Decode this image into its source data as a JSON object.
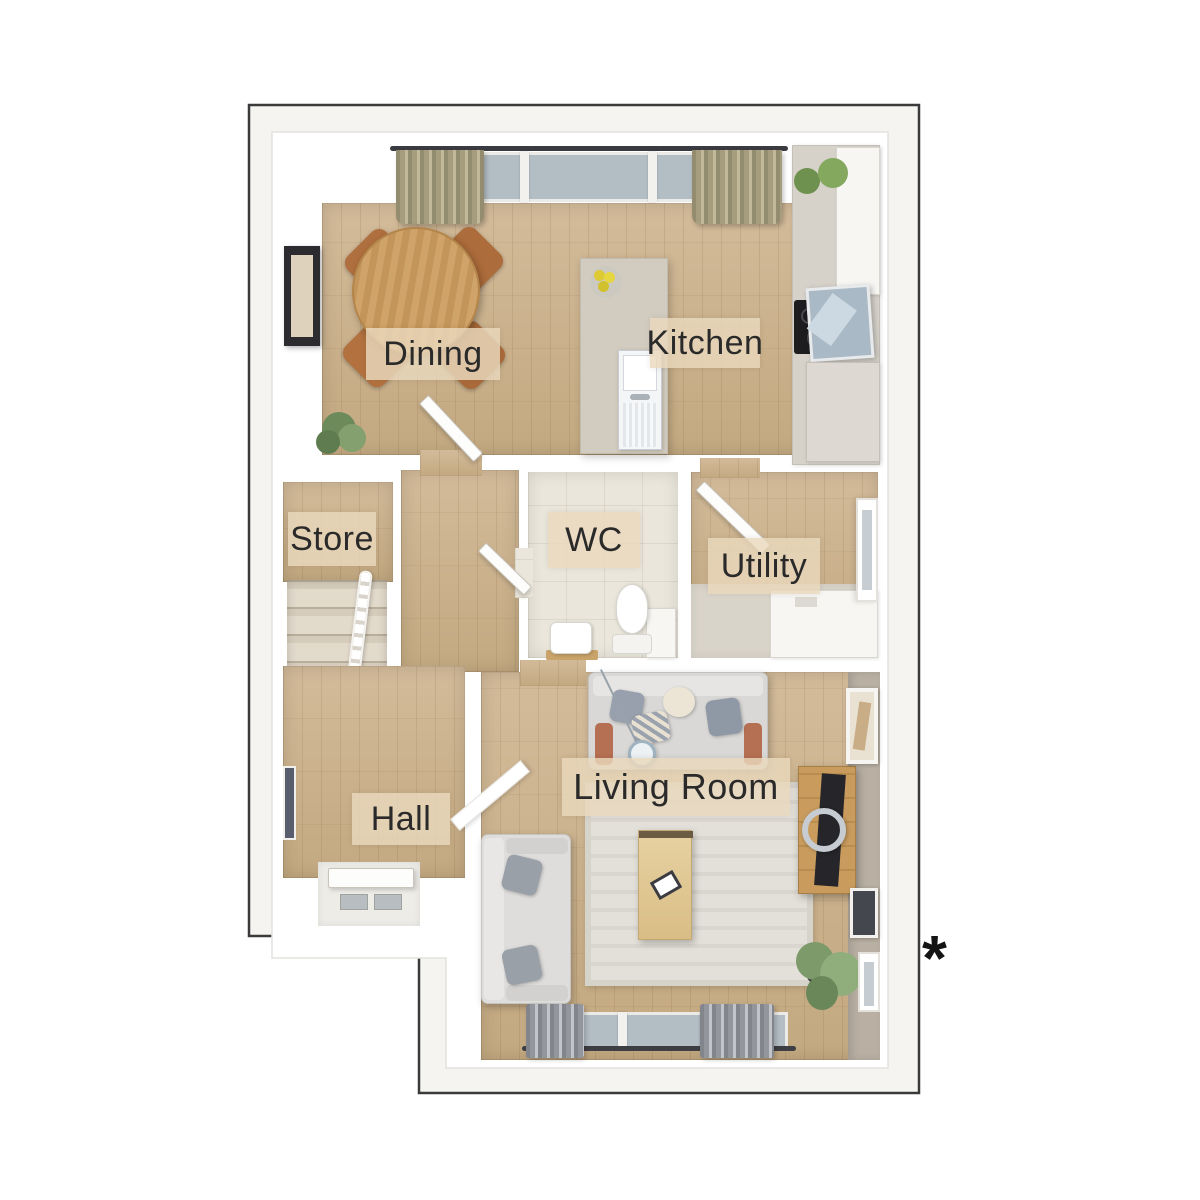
{
  "plan": {
    "rooms": {
      "dining": {
        "label": "Dining"
      },
      "kitchen": {
        "label": "Kitchen"
      },
      "store": {
        "label": "Store"
      },
      "wc": {
        "label": "WC"
      },
      "utility": {
        "label": "Utility"
      },
      "hall": {
        "label": "Hall"
      },
      "living_room": {
        "label": "Living Room"
      }
    },
    "footnote_marker": "*"
  },
  "palette": {
    "outline_color": "#3a3a3a",
    "plan_bg": "#f5f4f1",
    "wall_color": "#ffffff",
    "wood_floor": "#d3bb9a",
    "wood_floor_dark": "#c3a981",
    "carpet": "#d6ccbc",
    "tile_floor": "#eae6db",
    "label_bg": "#ead9bd",
    "label_text": "#2a2a2a",
    "sofa_gray": "#d9d8d6",
    "terracotta": "#b56f52",
    "furniture_wood": "#c99c5e",
    "plant_green": "#7d9a6b",
    "glass_blue": "#b3bdc4",
    "curtain_olive": "#a69d7e",
    "curtain_gray": "#94969e",
    "dark_appliance": "#1d1d20",
    "steel": "#c3c8cc"
  }
}
